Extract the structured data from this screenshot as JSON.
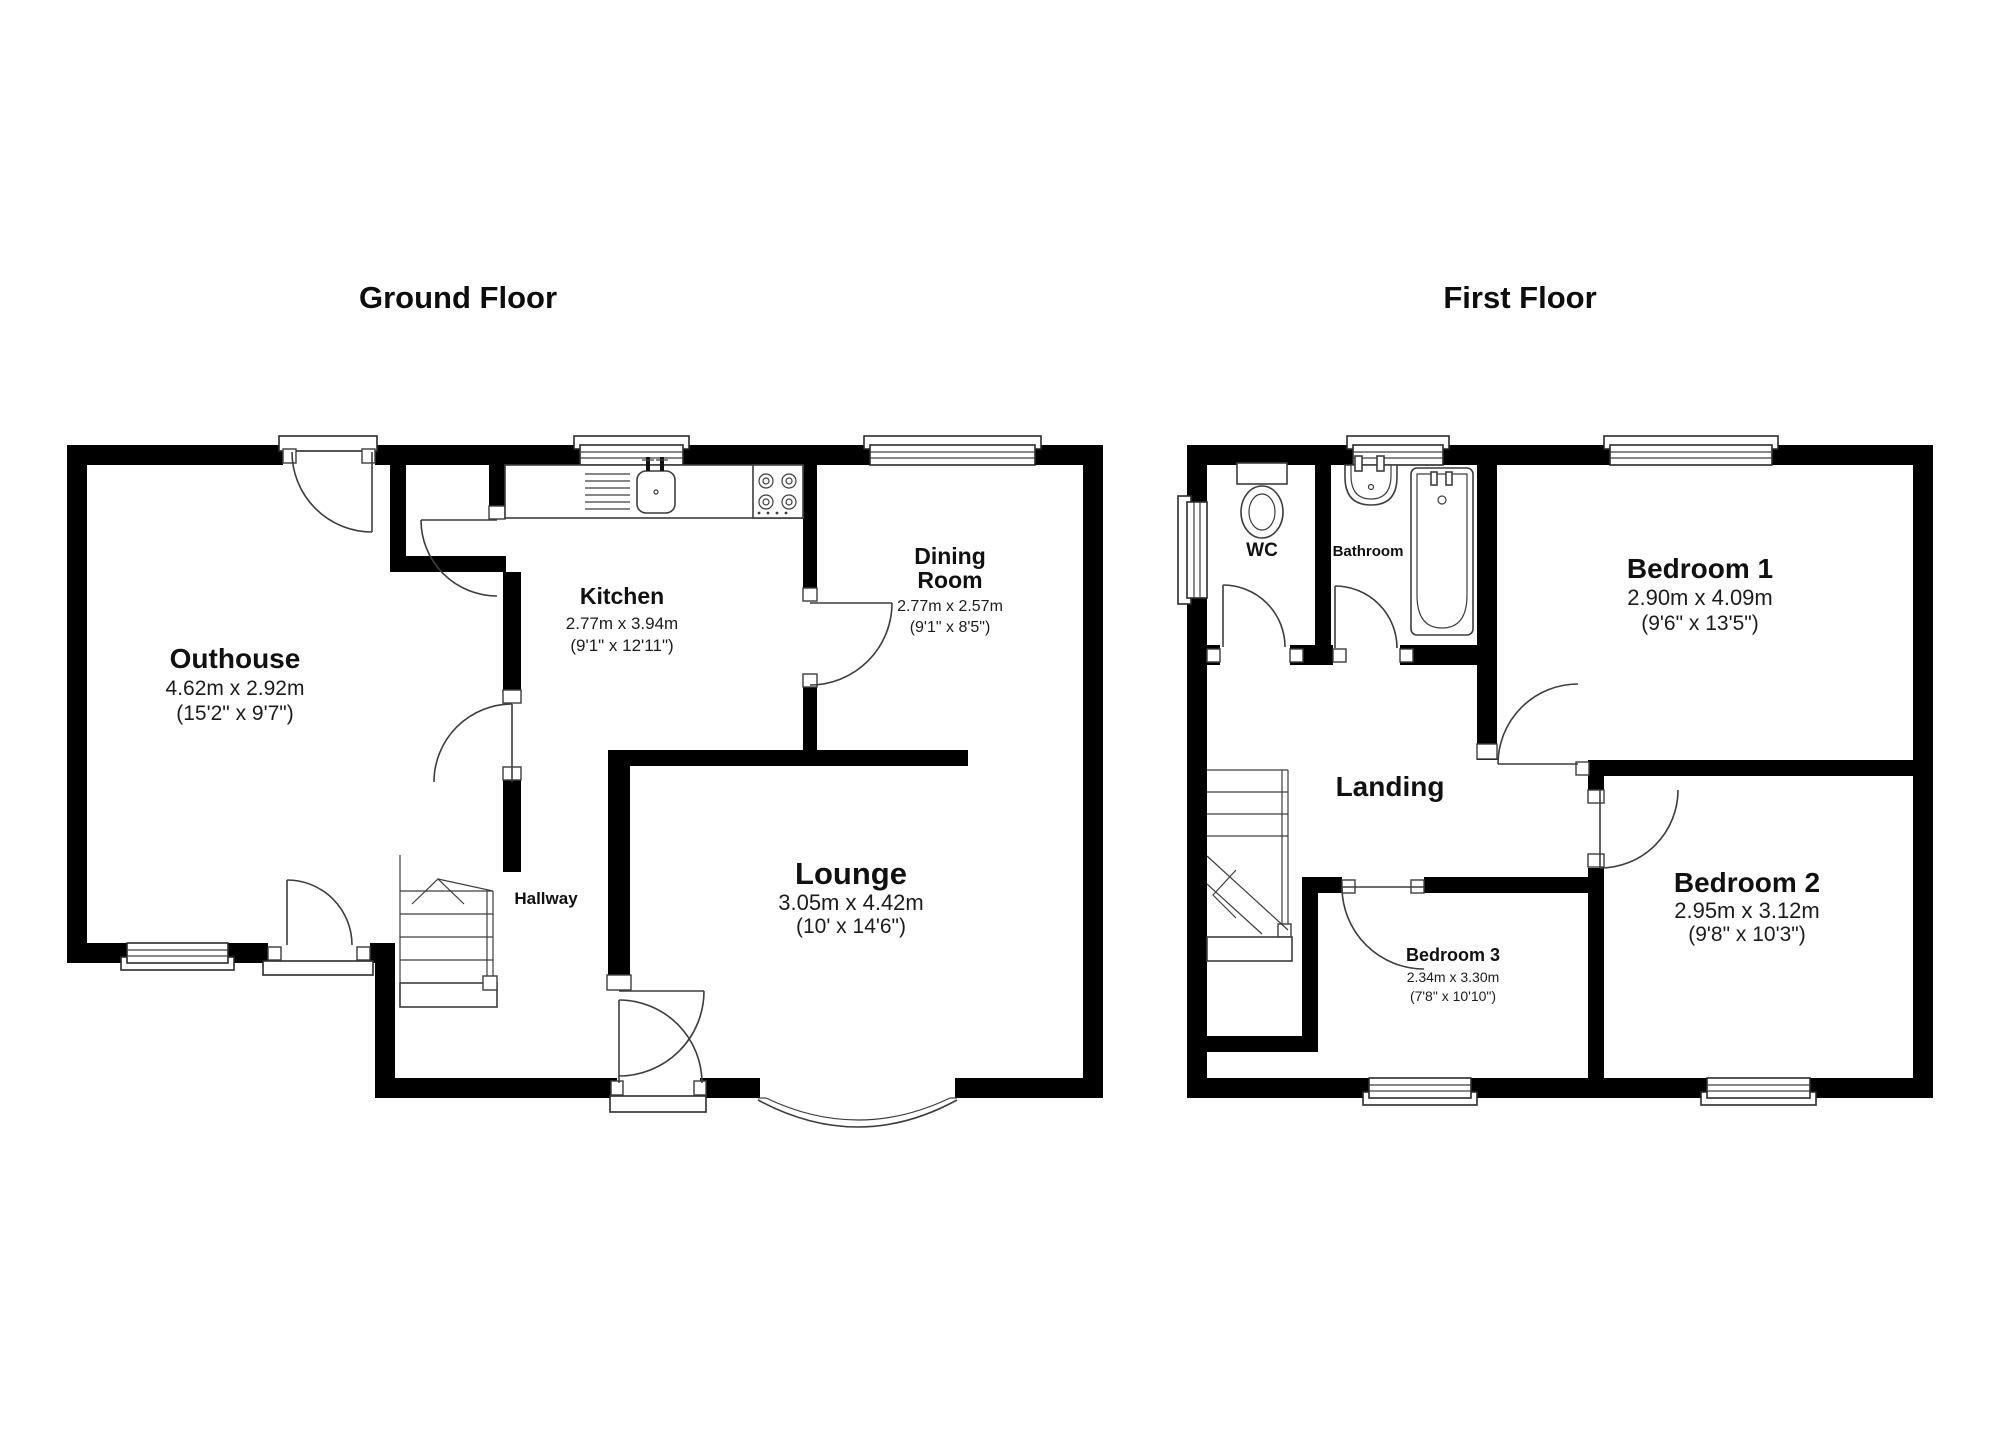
{
  "document": {
    "type": "floorplan"
  },
  "colors": {
    "wall": "#000000",
    "line": "#3d3d3d",
    "background": "#ffffff",
    "text": "#111111"
  },
  "ground_floor": {
    "title": "Ground Floor",
    "rooms": {
      "outhouse": {
        "name": "Outhouse",
        "metric": "4.62m x 2.92m",
        "imperial": "(15'2\" x 9'7\")"
      },
      "kitchen": {
        "name": "Kitchen",
        "metric": "2.77m x 3.94m",
        "imperial": "(9'1\" x 12'11\")"
      },
      "dining": {
        "name_line1": "Dining",
        "name_line2": "Room",
        "metric": "2.77m x 2.57m",
        "imperial": "(9'1\" x 8'5\")"
      },
      "lounge": {
        "name": "Lounge",
        "metric": "3.05m x 4.42m",
        "imperial": "(10' x 14'6\")"
      },
      "hallway": {
        "name": "Hallway"
      }
    }
  },
  "first_floor": {
    "title": "First Floor",
    "rooms": {
      "wc": {
        "name": "WC"
      },
      "bathroom": {
        "name": "Bathroom"
      },
      "bedroom1": {
        "name": "Bedroom 1",
        "metric": "2.90m x 4.09m",
        "imperial": "(9'6\" x 13'5\")"
      },
      "landing": {
        "name": "Landing"
      },
      "bedroom2": {
        "name": "Bedroom 2",
        "metric": "2.95m x 3.12m",
        "imperial": "(9'8\" x 10'3\")"
      },
      "bedroom3": {
        "name": "Bedroom 3",
        "metric": "2.34m x 3.30m",
        "imperial": "(7'8\" x 10'10\")"
      }
    }
  }
}
